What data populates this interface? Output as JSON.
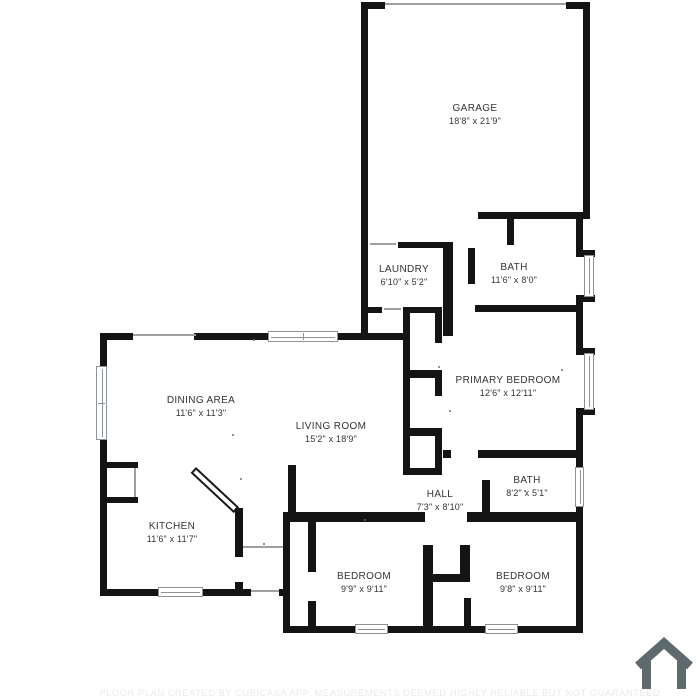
{
  "title": "Floor plan",
  "rooms": [
    {
      "id": "garage",
      "name": "GARAGE",
      "dims": "18'8\" x 21'9\""
    },
    {
      "id": "laundry",
      "name": "LAUNDRY",
      "dims": "6'10\" x 5'2\""
    },
    {
      "id": "bath-upper",
      "name": "BATH",
      "dims": "11'6\" x 8'0\""
    },
    {
      "id": "primary-bedroom",
      "name": "PRIMARY BEDROOM",
      "dims": "12'6\" x 12'11\""
    },
    {
      "id": "dining-area",
      "name": "DINING AREA",
      "dims": "11'6\" x 11'3\""
    },
    {
      "id": "living-room",
      "name": "LIVING ROOM",
      "dims": "15'2\" x 18'9\""
    },
    {
      "id": "kitchen",
      "name": "KITCHEN",
      "dims": "11'6\" x 11'7\""
    },
    {
      "id": "hall",
      "name": "HALL",
      "dims": "7'3\" x 8'10\""
    },
    {
      "id": "bath-lower",
      "name": "BATH",
      "dims": "8'2\" x 5'1\""
    },
    {
      "id": "bedroom-left",
      "name": "BEDROOM",
      "dims": "9'9\" x 9'11\""
    },
    {
      "id": "bedroom-right",
      "name": "BEDROOM",
      "dims": "9'8\" x 9'11\""
    }
  ],
  "footer": {
    "disclaimer": "FLOOR PLAN CREATED BY CUBICASA APP. MEASUREMENTS DEEMED HIGHLY RELIABLE BUT NOT GUARANTEED"
  },
  "colors": {
    "wall": "#141414",
    "window_frame": "#8d9296",
    "door_line": "#9aa0a3",
    "label": "#333333",
    "logo": "#5e6a6e",
    "disclaimer": "#eaeaea"
  }
}
